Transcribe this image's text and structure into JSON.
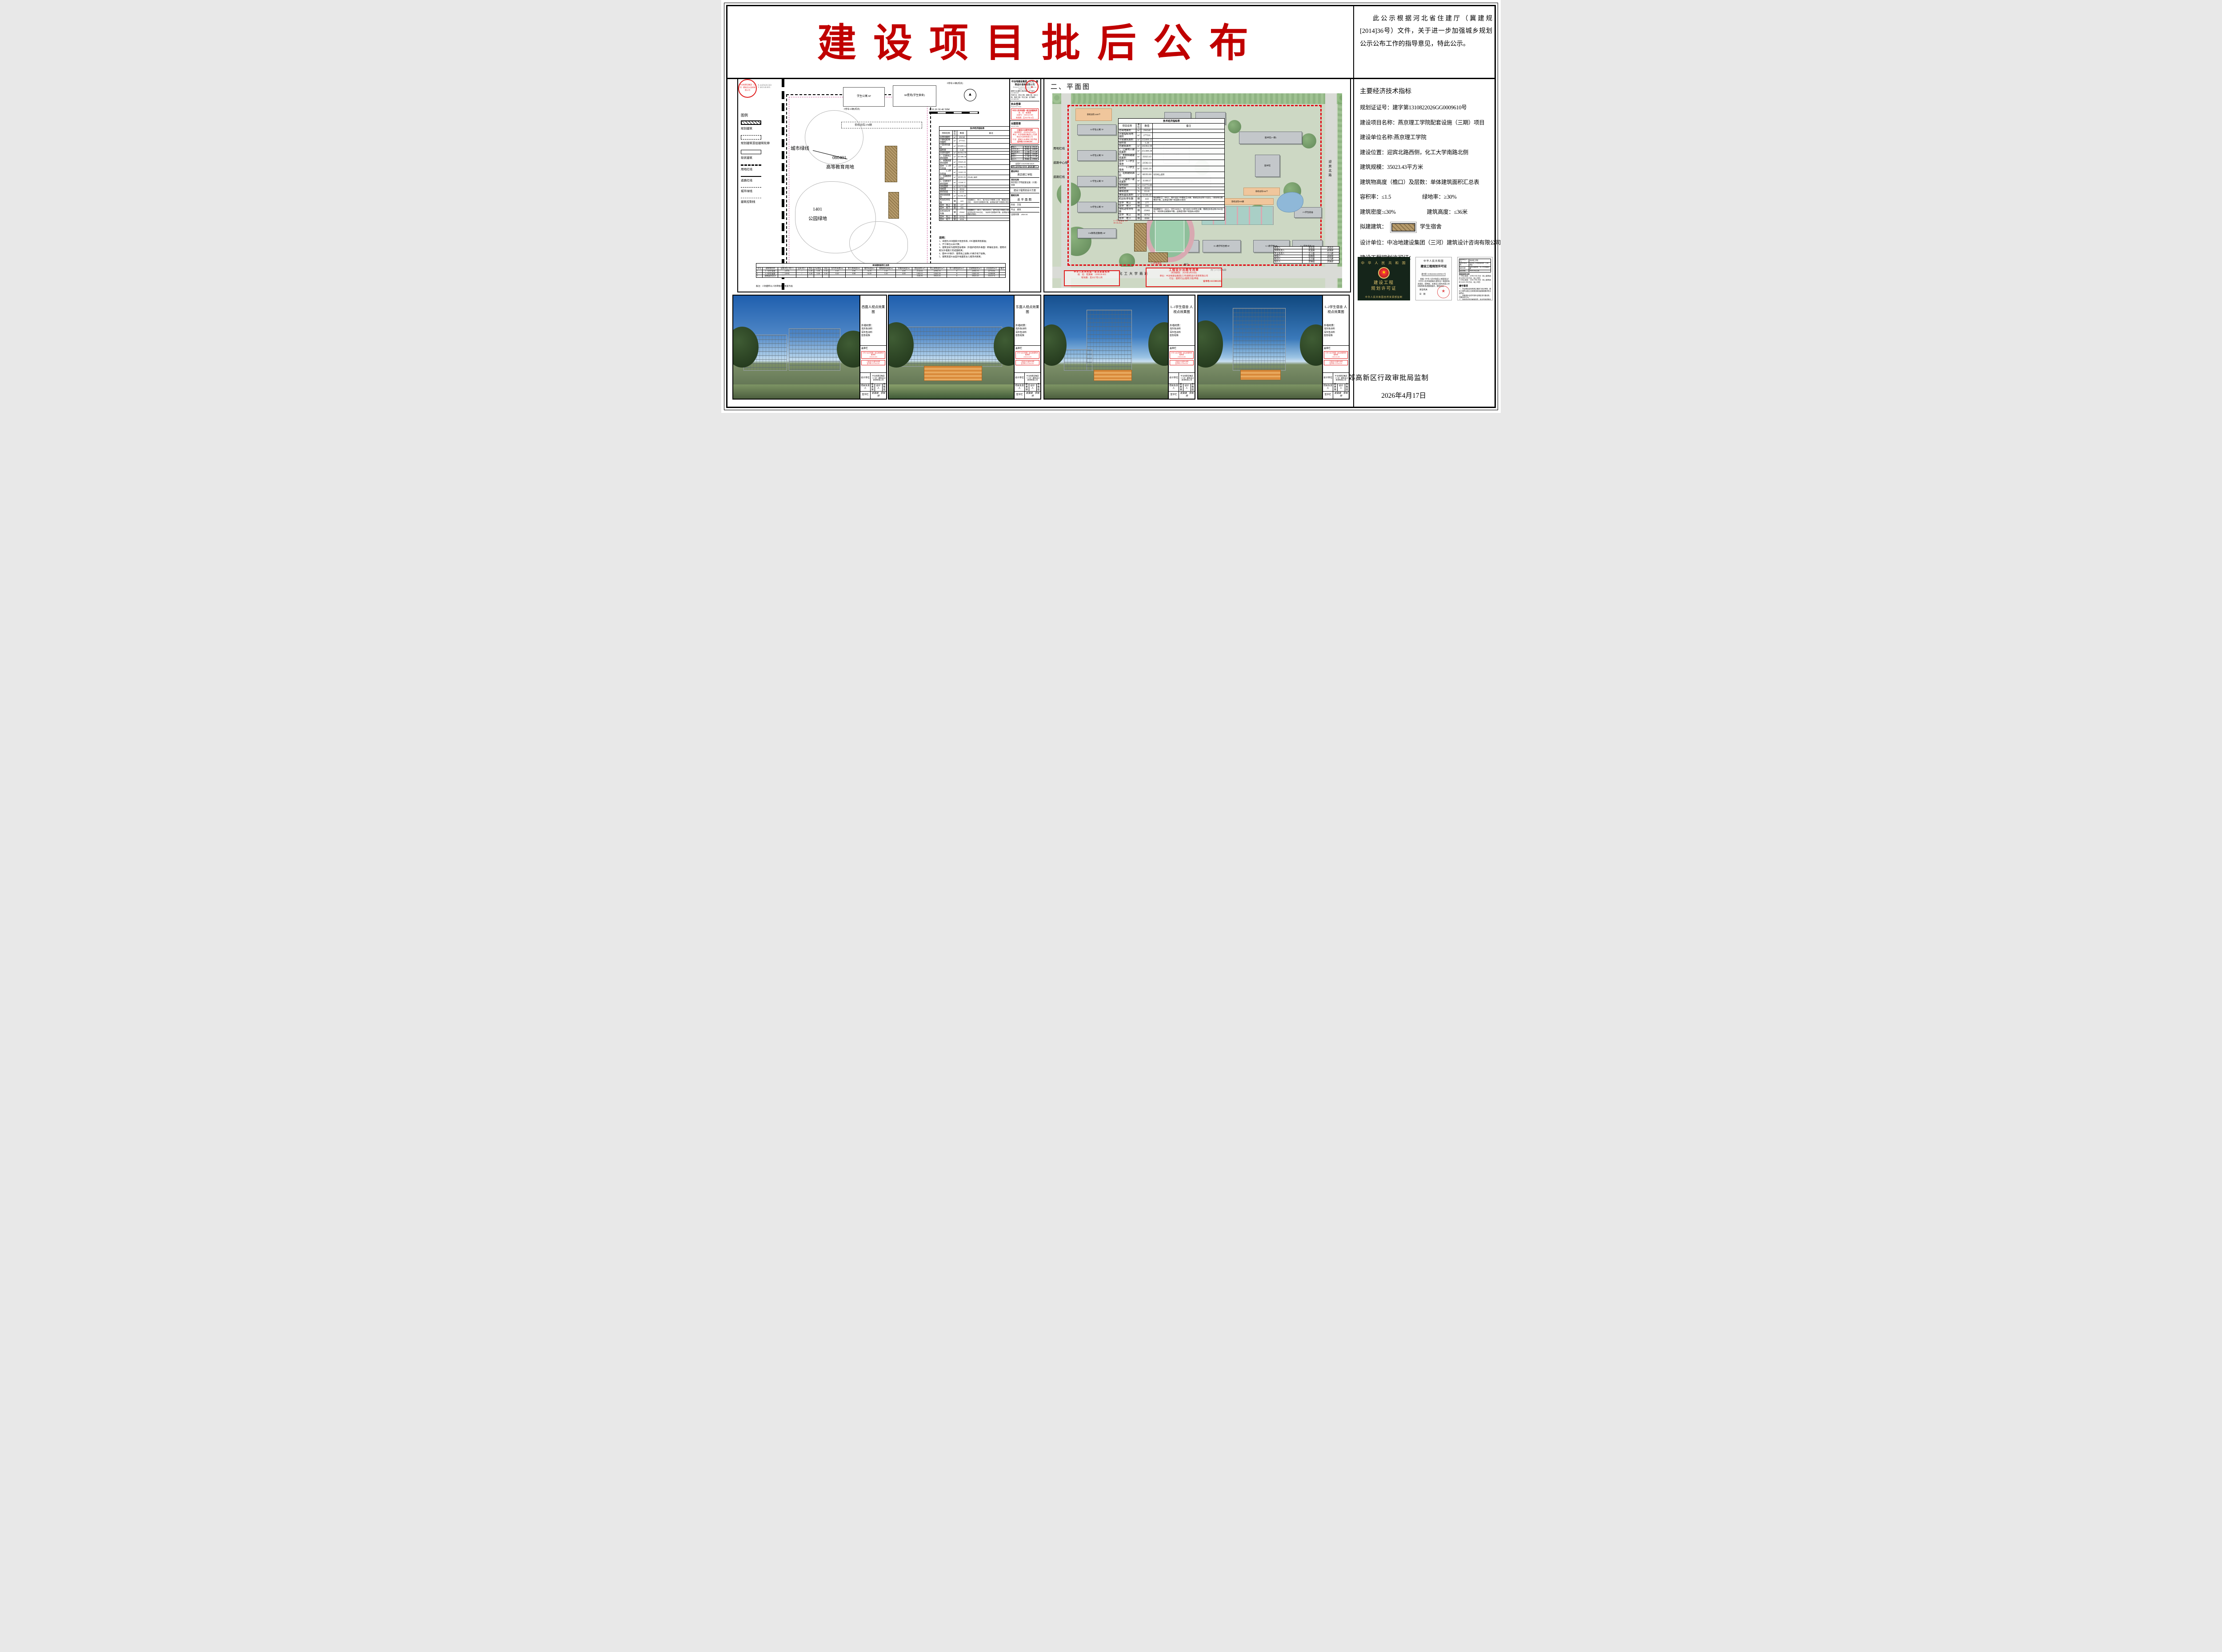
{
  "colors": {
    "title_red": "#C00000",
    "stamp_red": "#E02020",
    "boundary_red": "#E30613",
    "proposed_brown": "#B59A6B",
    "cover_green": "#15251A"
  },
  "page": {
    "title": "建设项目批后公布",
    "notice": "此公示根据河北省住建厅（冀建规[2014]36号）文件，关于进一步加强城乡规划公示公布工作的指导意见，特此公示。",
    "supervisor": "燕郊高新区行政审批局监制",
    "date": "2026年4月17日"
  },
  "right_panel": {
    "heading": "主要经济技术指标",
    "plan_cert_no": "规划证证号：建字第1310822026GG0009610号",
    "project_name": "建设项目名称：燕京理工学院配套设施（三期）项目",
    "owner": "建设单位名称:燕京理工学院",
    "location": "建设位置：迎宾北路西侧，化工大学南路北侧",
    "scale": "建筑规模：35023.43平方米",
    "height_floors": "建筑物高度（檐口）及层数：单体建筑面积汇总表",
    "far": "容积率：≤1.5",
    "green_rate": "绿地率：≥30%",
    "density": "建筑密度:≤30%",
    "bheight": "建筑高度：≤36米",
    "proposed_label": "拟建建筑：",
    "proposed_value": "学生宿舍",
    "designer": "设计单位：中冶地建设集团（三河）建筑设计咨询有限公司",
    "permit_label": "建设工程规划许可证："
  },
  "certs": {
    "cover": {
      "country": "中 华 人 民 共 和 国",
      "star": "★",
      "t1": "建设工程",
      "t2": "规划许可证",
      "footer": "中华人民共和国自然资源部监制"
    },
    "page": {
      "country": "中华人民共和国",
      "title": "建设工程规划许可证",
      "no": "建字第 1310822026GG0009610 号",
      "body": "根据《中华人民共和国土地管理法》《中华人民共和国城乡规划法》和国家有关规定，经审核，本建设工程符合国土空间规划和用途管制要求，颁发此证。",
      "issuer": "发证机关",
      "date_label": "日　期",
      "seal": "★"
    },
    "terms": {
      "pairs": {
        "rows": [
          [
            "建设单位(个人)",
            "燕京理工学院"
          ],
          [
            "建设项目名称",
            "燕京理工学院配套设施（三期）项目"
          ],
          [
            "建设位置",
            "迎宾北路西侧，化工大学南路北侧"
          ],
          [
            "建设规模",
            "35023.43平方米"
          ]
        ]
      },
      "attach_label": "附图及附件名称",
      "attach1": "L-1学生宿舍：22582.33平方米（地上建筑面积:22582.33平方米，地上10层）",
      "attach2": "L-2学生宿舍：12441.10平方米（地上建筑面积:12441.10平方米，地上10层）",
      "title": "遵守事项",
      "items": [
        "一、本证是经自然资源主管部门依法审核，建设工程符合国土空间规划和用途管制要求的法律凭证。",
        "二、未取得本证或不按本证规定进行建设的，均属违法行为。",
        "三、未经发证机关审核同意，本证的各项规定不得随意变更。",
        "四、自然资源主管部门依法有权查验本证，建设单位（个人）有责任提交查验。",
        "五、本证所需附图及附件由发证机关依法确定，与本证具有同等法律效力。"
      ]
    }
  },
  "indicator_table": {
    "title": "技术经济指标表",
    "columns": [
      "项目名称",
      "单位",
      "数值",
      "备注"
    ],
    "rows": [
      [
        "总用地面积",
        "m²",
        "294540",
        ""
      ],
      [
        "计算指标用地面积",
        "m²",
        "277531",
        ""
      ],
      [
        "计容建筑面积",
        "m²",
        "355099.12",
        ""
      ],
      [
        "容积率",
        "",
        "1.28",
        ""
      ],
      [
        "总建筑面积",
        "m²",
        "365962.98",
        ""
      ],
      [
        "1、已建地上建筑面积",
        "m²",
        "251386.38",
        ""
      ],
      [
        "2、本期拟建建筑面积",
        "m²",
        "35023.43",
        ""
      ],
      [
        "其中　L-1学生宿舍",
        "m²",
        "22582.33",
        ""
      ],
      [
        "　　　L-2学生宿舍",
        "m²",
        "12441.10",
        ""
      ],
      [
        "3、远期建筑面积",
        "m²",
        "68393.00",
        "均为地上面积"
      ],
      [
        "4、已建地下建筑面积",
        "m²",
        "11160.17",
        ""
      ],
      [
        "绿地面积",
        "m²",
        "112775.88",
        ""
      ],
      [
        "绿地率",
        "%",
        "40.64",
        ""
      ],
      [
        "建筑密度",
        "%",
        "22.41",
        ""
      ],
      [
        "建筑基底面积",
        "m²",
        "62186.48",
        ""
      ],
      [
        "机动车停车数",
        "辆",
        "443",
        "校园教职工：660人，按20泊位/100教职工计算，需建设机动车132泊位。（地块车位数整体平衡，此数值为整个校园统计规划）"
      ],
      [
        "其中　地上",
        "辆",
        "177",
        ""
      ],
      [
        "其中　地下",
        "辆",
        "266",
        ""
      ],
      [
        "非机动车停车数",
        "辆",
        "25662",
        "校园教职工：660人，学生36000人，按70泊位/100师生计算，需建设非机动车25662泊位。（地块车位数整体平衡，此数值为整个校园统计规划）"
      ],
      [
        "其中　地上",
        "辆",
        "18762",
        ""
      ],
      [
        "其中　地下",
        "辆",
        "6900",
        ""
      ]
    ]
  },
  "summary_table": {
    "title": "单体建筑面积汇总表",
    "columns": [
      "序号",
      "建筑物名称",
      "层数(地上/地下)",
      "层高:地下",
      "首层",
      "标准层",
      "顶层",
      "室内外高差(m)",
      "女儿墙高度(m)",
      "檐口高度(m)",
      "楼电梯间高度(m)",
      "水箱间高度(m)",
      "首层面积(m²)",
      "地上建筑面积(m²)",
      "地下建筑面积(m²)",
      "总建筑面积(m²)",
      "计容面积(m²)",
      "备注"
    ],
    "rows": [
      [
        "1",
        "L-1学生宿舍",
        "(10/0)",
        "/",
        "4.20",
        "3.30",
        "3.30",
        "0.45",
        "0.90",
        "34.35",
        "3.10",
        "4.00",
        "2144.62",
        "22582.33",
        "0",
        "22582.33",
        "22730.84",
        ""
      ],
      [
        "2",
        "L-2学生宿舍",
        "(10/0)",
        "/",
        "4.20",
        "3.30",
        "3.30",
        "0.45",
        "0.90",
        "34.35",
        "3.10",
        "4.00",
        "1202.31",
        "12441.10",
        "0",
        "12441.10",
        "12588.90",
        ""
      ],
      [
        "3",
        "建筑面积总计",
        "",
        "",
        "",
        "",
        "",
        "",
        "",
        "",
        "",
        "",
        "3346.93",
        "35023.43",
        "0",
        "35023.43",
        "35319.74",
        ""
      ]
    ],
    "note": "备注：人防面积以人防审批部门批复为准"
  },
  "left_plan": {
    "coord_x": "X 4429420.583",
    "coord_y": "Y 482148.805",
    "legend_title": "图例",
    "legend": [
      {
        "label": "规划建筑",
        "style": "sw-hatch"
      },
      {
        "label": "规划建筑首层建筑轮廓",
        "style": "sw-dashed"
      },
      {
        "label": "现状建筑",
        "style": "sw-solid"
      },
      {
        "label": "用地红线",
        "style": "sw-redline"
      },
      {
        "label": "道路红线",
        "style": "sw-line"
      },
      {
        "label": "城市绿线",
        "style": "sw-dashdot"
      },
      {
        "label": "建筑控制线",
        "style": "sw-ctrl"
      }
    ],
    "city_green_line": "城市绿线",
    "parcel_code": "080401",
    "parcel_use": "高等教育用地",
    "park_code": "1401",
    "park_use": "公园绿地",
    "bike378": "非机动车378辆",
    "dorm": "学生公寓",
    "dorm_fl": "6F",
    "xingyuan": "8#星苑(学生宿舍)",
    "p18": "P停车18辆(现状)",
    "p10": "P停车10辆(现状)",
    "jingrui": "晶锐公司",
    "scale_text": "0   10   20   30   40   50M",
    "notes_title": "说明：",
    "notes": [
      "1、本图为2000国家大地坐标系, 1985国家高程基准；",
      "2、尺寸单位以米计算；",
      "3、建筑坐标为建筑首层墙体（外围护结构外表面）转角处坐标，建筑间距为外墙施工完成面距离；",
      "4、图中10F表示：建筑地上层数;1D表示地下层数。",
      "5、建筑高度H:由室外地面至女儿墙顶点距离；"
    ]
  },
  "titleblock": {
    "company_name": "中冶地建设集团（三河）建筑设计咨询有限公司",
    "company_en": "Zhongyedi Construction Group Architecture Design Consult Co.Ltd.",
    "cert1": "建筑行业(建筑工程)甲级　证书编号：A113001205",
    "cert2": "市政行业（排水工程、道路工程、给水工程、桥梁工程）专业乙级　证书编号：A213001202",
    "reg_stamp_label": "执业签章",
    "reg_stamp_en": "Registration Stamp",
    "rel_stamp_label": "出图签章",
    "rel_stamp_en": "Release Stamp",
    "sign_rows": {
      "rows": [
        [
          "审定人",
          "李志忠",
          "李志忠"
        ],
        [
          "项目负责人",
          "崔美婧",
          "崔美婧"
        ],
        [
          "专业负责人",
          "王小晨",
          "王小晨"
        ],
        [
          "审核人",
          "张晓梅",
          "张晓梅"
        ],
        [
          "校对人",
          "王小晨",
          "王小晨"
        ],
        [
          "设计人",
          "李琳娅",
          "李琳娅"
        ]
      ]
    },
    "countersign_label": "会签栏 COUNTER SIGN",
    "countersign": {
      "rows": [
        [
          "建筑",
          "结构",
          "给排水",
          "暖通",
          "电气"
        ]
      ]
    },
    "owner_label": "建设单位",
    "owner": "燕京理工学院",
    "project_label": "项目名称",
    "project": "燕京理工学院配套设施（三期）项目",
    "scheme": "建设工程规划设计方案",
    "dwg_label": "图纸名称",
    "dwg": "总平面图",
    "phase_label": "阶段",
    "phase": "方案",
    "discipline_label": "专业",
    "discipline": "建筑",
    "date_label": "出图日期",
    "date": "2026.04"
  },
  "stamps": {
    "architect": {
      "title": "中华人民共和国一级注册建筑师",
      "name_l": "姓　名：",
      "name": "崔美婧",
      "reg_l": "注册号：",
      "reg": "1300120-005",
      "valid_l": "有效期：",
      "valid": "至2027年12月"
    },
    "release": {
      "l1": "工程设计出图专用章",
      "l2": "(有效期至：2026年4月30日)",
      "l3": "单位：中冶地建设集团(三河)建筑设计咨询有限公司",
      "l4": "行业：建筑行业(建筑工程)甲级",
      "l5": "证书号:A113001205"
    }
  },
  "plan": {
    "header": "二、平面图",
    "labels": [
      "A5学生公寓 7F",
      "A6学生公寓 7F",
      "A7学生公寓 7F",
      "A8学生公寓 7F",
      "11#静苑(后勤楼) 6F",
      "非机动车1400个",
      "二食堂",
      "8#星苑(学生宿舍)",
      "图书馆(一期)",
      "图书馆",
      "非机动车566个",
      "E-4教学实训楼 8F",
      "E-2教学综合楼 8F",
      "G-3教学楼 8F",
      "G-1学生宿舍 9F",
      "J-3学生宿舍",
      "L-1学生宿舍 10F H=35.25m",
      "L-2学生宿舍",
      "非机动车900辆",
      "南门人行出入口",
      "化工大学南路",
      "迎宾北路",
      "用地红线",
      "道路中心线",
      "道路红线",
      "校门"
    ]
  },
  "renders": {
    "r1": {
      "title": "西面人视点效果图"
    },
    "r2": {
      "title": "东面人视点效果图"
    },
    "r3": {
      "title": "L-1学生宿舍 人视点效果图"
    },
    "r4": {
      "title": "L-2学生宿舍 人视点效果图"
    },
    "materials_label": "外墙材质：",
    "m1": "浅灰色涂料",
    "m2": "深灰色涂料",
    "m3": "蓝色铝板",
    "stamp_col": "盖章栏",
    "design_unit_label": "设计单位",
    "design_unit": "中冶地建设集团（三河）建筑设计咨询有限公司",
    "pm_label": "项目负责人",
    "pm": "崔美婧",
    "designer_label": "设计人",
    "designer": "李琳娅",
    "sign_label": "签字栏",
    "sign_names": "崔美婧　李琳娅"
  }
}
